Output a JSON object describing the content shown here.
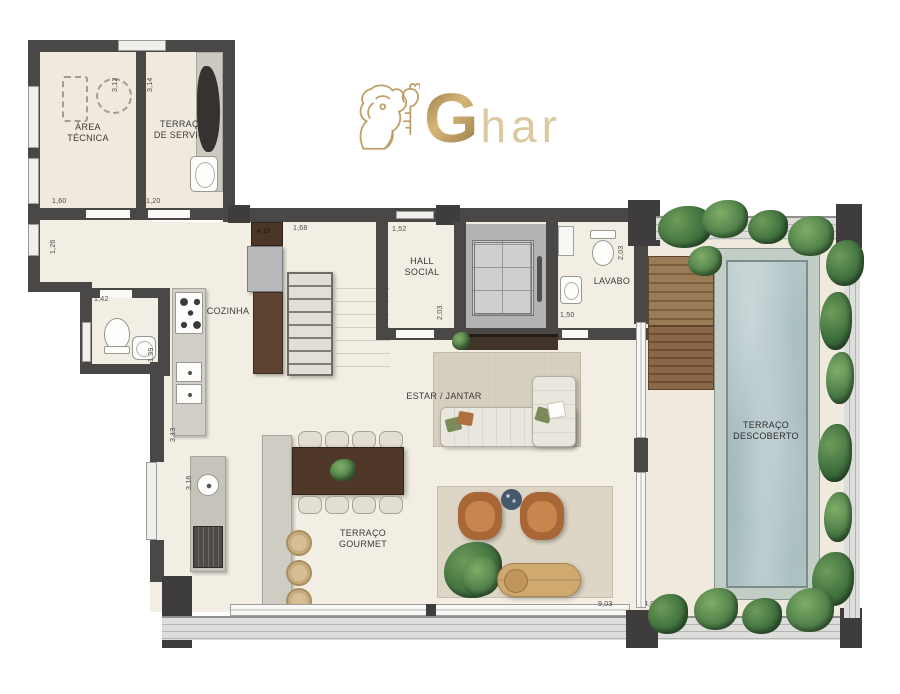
{
  "logo": {
    "g": "G",
    "har": "har",
    "icon": "lion-with-key"
  },
  "labels": {
    "area_tecnica": "ÁREA\nTÉCNICA",
    "terraco_servico": "TERRAÇO\nDE SERVIÇO",
    "hall_social": "HALL\nSOCIAL",
    "lavabo": "LAVABO",
    "cozinha": "COZINHA",
    "estar_jantar": "ESTAR / JANTAR",
    "terraco_gourmet": "TERRAÇO\nGOURMET",
    "terraco_descoberto": "TERRAÇO\nDESCOBERTO"
  },
  "dimensions": {
    "d_3_12": "3,12",
    "d_3_14": "3,14",
    "d_1_60": "1,60",
    "d_1_20": "1,20",
    "d_1_26": "1,26",
    "d_1_42": "1,42",
    "d_1_39": "1,39",
    "d_4_15": "4,15",
    "d_1_68": "1,68",
    "d_1_52": "1,52",
    "d_2_03_hall": "2,03",
    "d_2_03_lavabo": "2,03",
    "d_1_50": "1,50",
    "d_3_13": "3,13",
    "d_3_16": "3,16",
    "d_9_03": "9,03",
    "d_4_02": "4,02"
  },
  "colors": {
    "logo_gold": "#bfa066",
    "wall": "#4a4747",
    "floor": "#f3eee3",
    "pool_water": "#a7bcbf",
    "wood_deck": "#8a6748",
    "plants": "#3f6f3d",
    "dark_wood": "#4f3827"
  }
}
